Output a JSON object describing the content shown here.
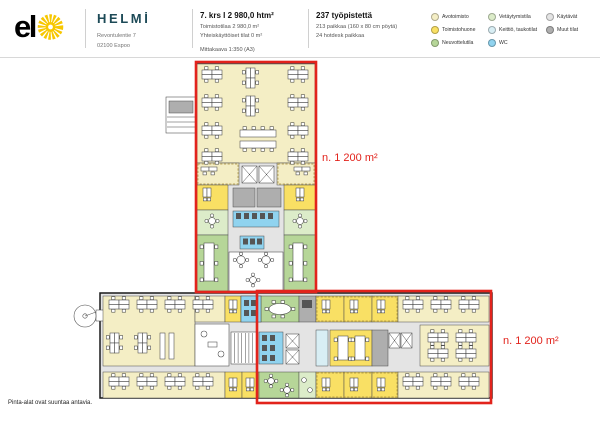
{
  "header": {
    "elo_logo_text": "el",
    "building": {
      "name": "HELMİ",
      "address_line1": "Revontulentie 7",
      "address_line2": "02100 Espoo"
    },
    "floor_stats": {
      "title": "7. krs I 2 980,0 htm²",
      "area_line": "Toimistotilaa 2 980,0 m²",
      "shared_line": "Yhteiskäyttöiset tilat 0 m²",
      "scale_line": "Mittakaava 1:350 (A3)"
    },
    "workstation_stats": {
      "title": "237 työpistettä",
      "line1": "213 paikkaa (160 x 80 cm pöytä)",
      "line2": "24 hotdesk paikkaa"
    },
    "legend": {
      "items": [
        {
          "label": "Avotoimisto",
          "color": "#F4EEC5"
        },
        {
          "label": "Toimistohuone",
          "color": "#F9E064"
        },
        {
          "label": "Neuvottelutila",
          "color": "#B6D698"
        },
        {
          "label": "Vetäytymistila",
          "color": "#DCECC9"
        },
        {
          "label": "Keittiö, taukotilat",
          "color": "#D8EEF4"
        },
        {
          "label": "WC",
          "color": "#90D3EF"
        },
        {
          "label": "Käytävät",
          "color": "#E4E4E4"
        },
        {
          "label": "Muut tilat",
          "color": "#AEAEAE"
        }
      ]
    }
  },
  "plan": {
    "outline_color": "#E2231C",
    "elo_sun_color": "#F7C700",
    "annotations": [
      {
        "text": "n. 1 200 m²"
      },
      {
        "text": "n. 1 200 m²"
      }
    ]
  },
  "footer": {
    "note": "Pinta-alat ovat suuntaa antavia."
  }
}
